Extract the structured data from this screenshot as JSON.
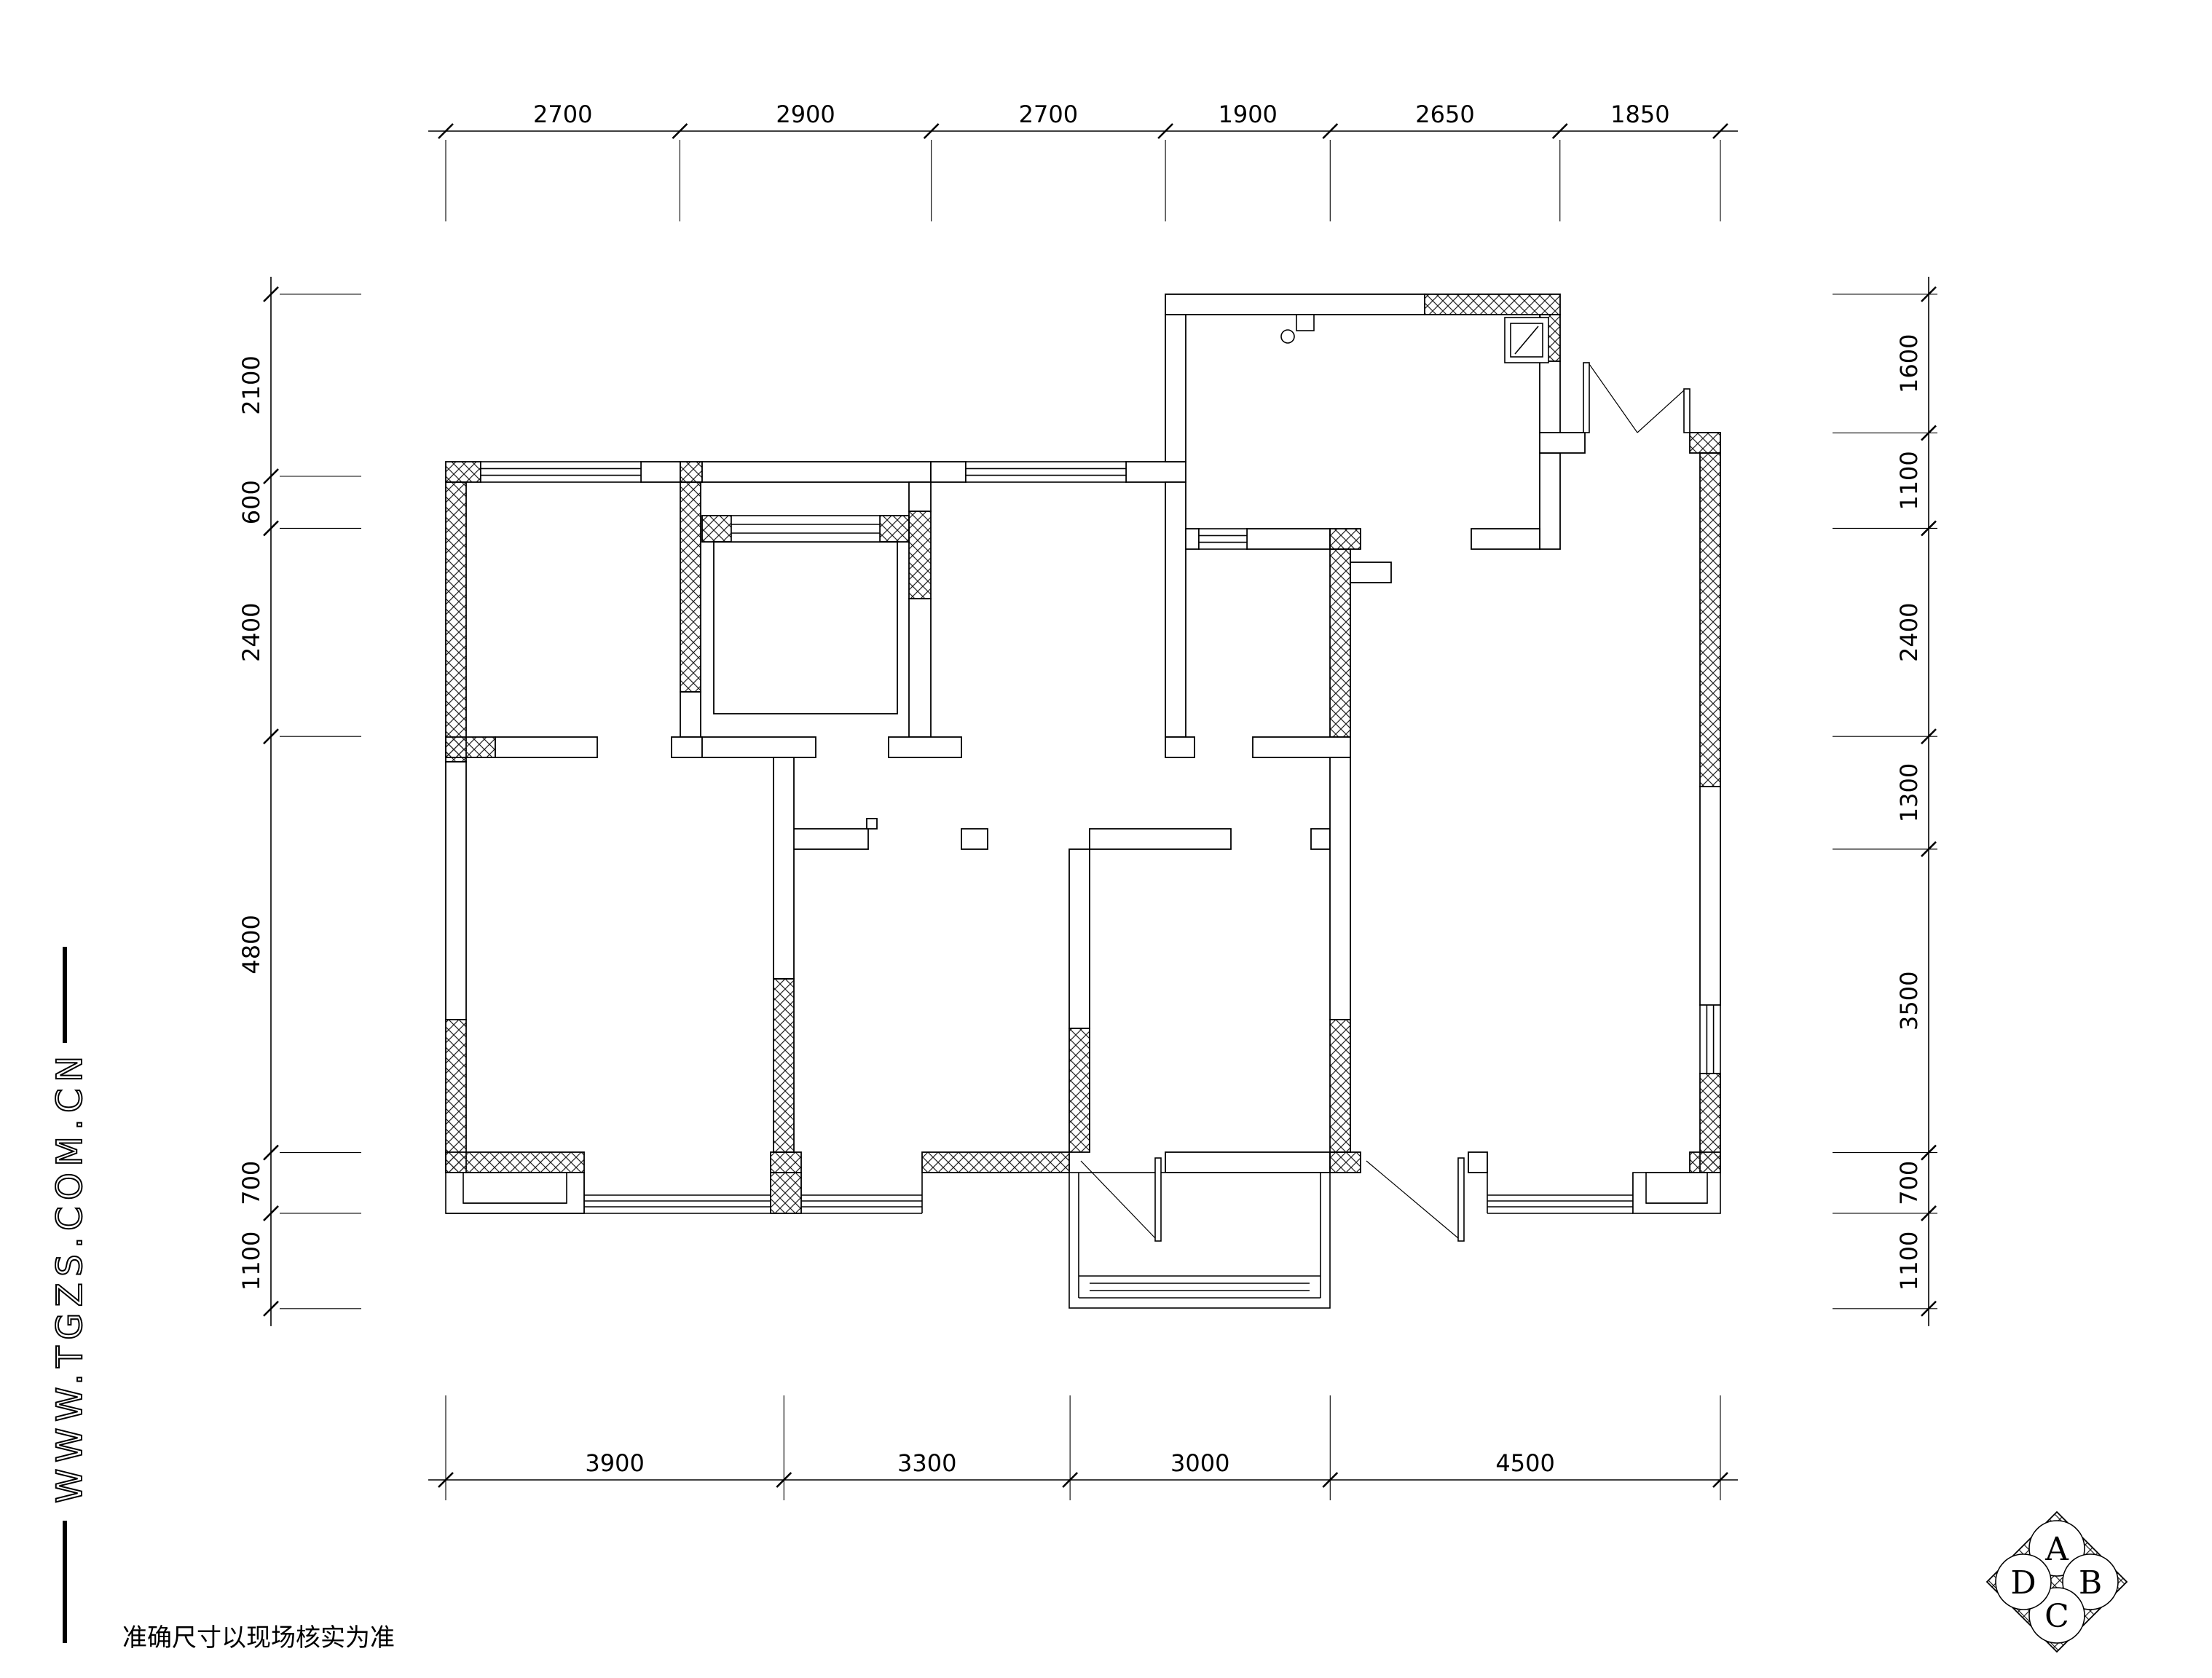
{
  "page": {
    "background": "#ffffff",
    "line_color": "#000000",
    "type_label": "floor-plan"
  },
  "dimensions": {
    "top": [
      "2700",
      "2900",
      "2700",
      "1900",
      "2650",
      "1850"
    ],
    "bottom": [
      "3900",
      "3300",
      "3000",
      "4500"
    ],
    "left": [
      "2100",
      "600",
      "2400",
      "4800",
      "700",
      "1100"
    ],
    "right": [
      "1600",
      "1100",
      "2400",
      "1300",
      "3500",
      "700",
      "1100"
    ]
  },
  "watermark": "WWW.TGZS.COM.CN",
  "disclaimer": "准确尺寸以现场核实为准",
  "logo": {
    "letters": [
      "A",
      "B",
      "C",
      "D"
    ]
  }
}
